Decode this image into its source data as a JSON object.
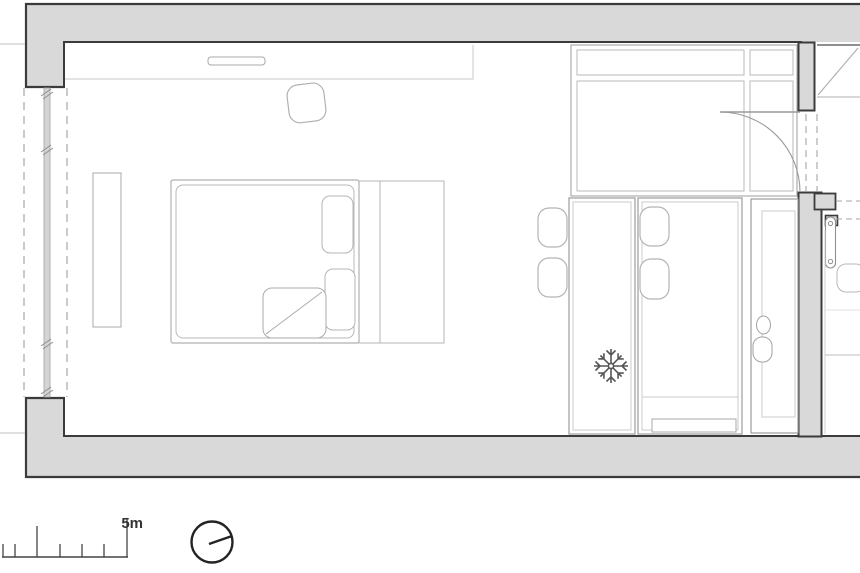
{
  "document": {
    "kind": "architectural-floor-plan",
    "view": "top-down studio apartment layout"
  },
  "scale_bar": {
    "label": "5m"
  },
  "symbols": {
    "fridge": "snowflake-icon",
    "orientation": "circle-pointer-dial-icon",
    "door_swing": "quarter-arc",
    "window_wall": "dashed-parallel-lines-with-glazing"
  },
  "furniture": [
    "double-bed",
    "pillows",
    "folded-blanket",
    "headboard",
    "bedside-platform",
    "wall-console",
    "bench-shelf",
    "armchair",
    "wardrobe",
    "dining-table",
    "chair-x4",
    "kitchen-island",
    "kitchen-counter",
    "sink",
    "refrigerator",
    "radiator"
  ],
  "colors": {
    "background": "#ffffff",
    "wall_fill": "#d9d9d9",
    "wall_outline": "#3b3b3b",
    "furniture_line": "#9c9c9c",
    "furniture_line_light": "#c6c6c6",
    "dashed_line": "#a6a6a6",
    "symbol_dark": "#565656",
    "scale_text": "#333333",
    "north_symbol": "#242424"
  }
}
